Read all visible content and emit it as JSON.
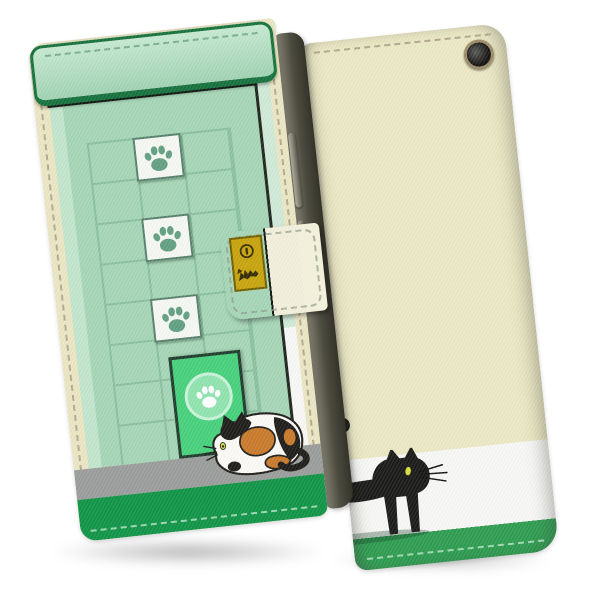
{
  "scene": {
    "type": "product-photo",
    "subject": "flip-wallet smartphone case with cat design, shown closed from front and from back",
    "views": [
      "front-closed",
      "back"
    ]
  },
  "colors": {
    "background": "#ffffff",
    "case_edge_cream": "#eae6c3",
    "stitch_on_cream": "#a79a84",
    "awning_fill": "#c6e9d1",
    "awning_fill_dark": "#9fd2b2",
    "awning_border": "#14713c",
    "shadow_band": "#141b14",
    "wall_mint": "#a5d5b6",
    "wall_highlight": "#c6e7d0",
    "side_strip_mint": "#cfe9d6",
    "grid_line": "#8abf9f",
    "tile_bg": "#f5f7f3",
    "tile_border": "#55806a",
    "paw_green": "#619f80",
    "door_fill": "#46d07b",
    "door_border": "#1f3a2b",
    "door_circle_fill": "#8fe3ae",
    "door_circle_ring": "#c8f3d8",
    "gray_strip": "#9a9c9b",
    "front_green_strip": "#0f9446",
    "strip_stitch": "#bfe6cc",
    "clasp_cream": "#f2efdb",
    "clasp_stitch": "#8f9a8c",
    "badge_gold": "#c7a30c",
    "badge_border": "#6f5e00",
    "badge_mark": "#352b00",
    "back_cream": "#ebe8c4",
    "back_white": "#f7f7f6",
    "back_green": "#2d9c50",
    "cat_black": "#191917",
    "cat_eye": "#d8e03c",
    "calico_white": "#fbf9f5",
    "calico_orange": "#c8792a",
    "calico_outline": "#1d1c19",
    "spine_dark": "#4d4c40",
    "spine_light": "#8b897a",
    "camera_ring": "#9b8a66",
    "camera_lens": "#151412"
  },
  "front_view": {
    "awning": {
      "style": "rounded green bar with dashed stitching"
    },
    "wall_grid": {
      "columns": 3,
      "rows": 8
    },
    "paw_tiles": {
      "count": 3,
      "icon": "paw-print-icon",
      "position": "middle column, rows 1 / 3 / 5"
    },
    "door": {
      "icon": "paw-print-icon",
      "shape": "cat flap door with round paw sign"
    },
    "cat": {
      "type": "calico-cat-sitting",
      "facing": "left"
    },
    "bottom_strips": [
      "gray",
      "green-stitched"
    ],
    "clasp": {
      "badge": {
        "icons": [
          "coin-slot-icon",
          "pixel-cat-icon"
        ],
        "color": "gold"
      }
    },
    "spine_buttons": {
      "count": 2
    }
  },
  "back_view": {
    "stripes_top_to_bottom": [
      "cream",
      "white",
      "green-stitched"
    ],
    "cat": {
      "type": "black-cat-walking",
      "facing": "right",
      "eye": "yellow",
      "clipped_at_left_edge": true
    },
    "tail_tip_visible_at_left_edge": true,
    "camera_hole": {
      "present": true,
      "position": "top-right"
    }
  }
}
